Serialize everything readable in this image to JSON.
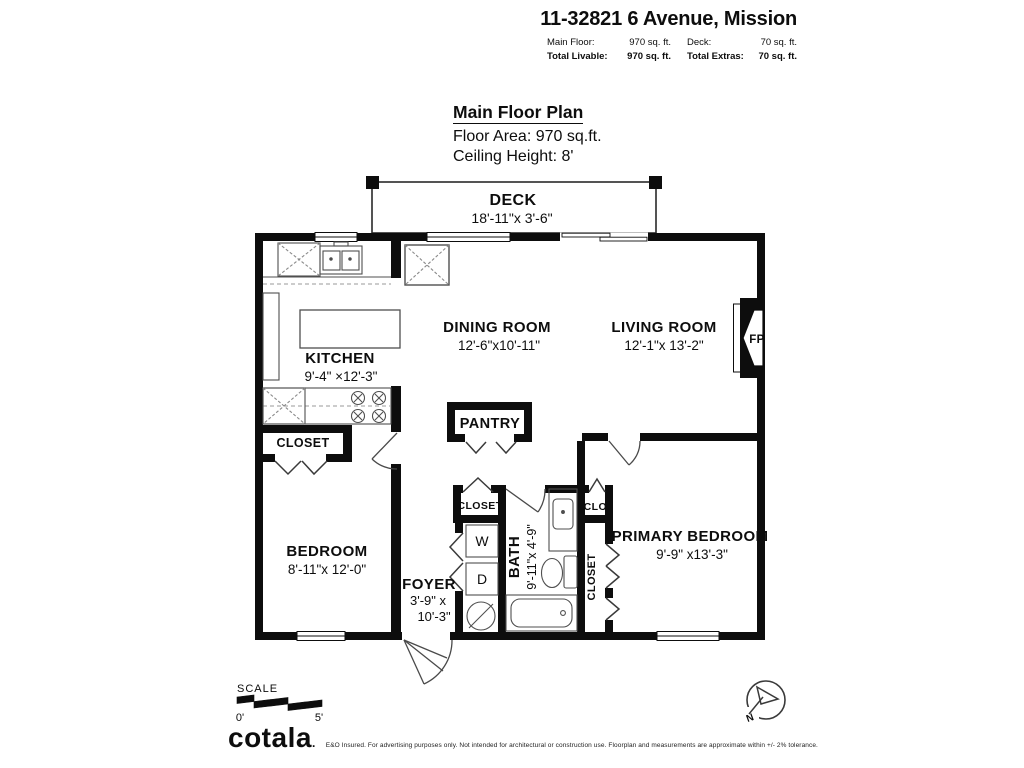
{
  "header": {
    "title": "11-32821 6 Avenue, Mission",
    "row1": {
      "label1": "Main Floor:",
      "value1": "970 sq. ft.",
      "label2": "Deck:",
      "value2": "70 sq. ft."
    },
    "row2": {
      "label1": "Total Livable:",
      "value1": "970 sq. ft.",
      "label2": "Total Extras:",
      "value2": "70 sq. ft."
    }
  },
  "plan_title": {
    "heading": "Main Floor Plan",
    "line1": "Floor Area: 970 sq.ft.",
    "line2": "Ceiling Height: 8'"
  },
  "rooms": {
    "deck": {
      "name": "DECK",
      "dims": "18'-11\"x 3'-6\""
    },
    "kitchen": {
      "name": "KITCHEN",
      "dims": "9'-4\" ×12'-3\""
    },
    "dining": {
      "name": "DINING ROOM",
      "dims": "12'-6\"x10'-11\""
    },
    "living": {
      "name": "LIVING ROOM",
      "dims": "12'-1\"x 13'-2\""
    },
    "pantry": {
      "name": "PANTRY"
    },
    "kitchen_closet": {
      "name": "CLOSET"
    },
    "bedroom": {
      "name": "BEDROOM",
      "dims": "8'-11\"x 12'-0\""
    },
    "foyer": {
      "name": "FOYER",
      "dims1": "3'-9\" x",
      "dims2": "10'-3\""
    },
    "foyer_closet": {
      "name": "CLOSET"
    },
    "laundry": {
      "washer": "W",
      "dryer": "D"
    },
    "bath": {
      "name": "BATH",
      "dims": "9'-11\"x 4'-9\""
    },
    "clo": {
      "name": "CLO."
    },
    "primary_closet": {
      "name": "CLOSET"
    },
    "primary": {
      "name": "PRIMARY BEDROOM",
      "dims": "9'-9\" x13'-3\""
    },
    "fireplace": {
      "label": "FP"
    }
  },
  "scale_bar": {
    "label": "SCALE",
    "tick_start": "0'",
    "tick_end": "5'"
  },
  "compass": {
    "north": "N"
  },
  "footer": {
    "logo": "cotala",
    "logo_mark": ".",
    "disclaimer": "E&O Insured. For advertising purposes only. Not intended for architectural or construction use. Floorplan and measurements are approximate within +/- 2% tolerance."
  }
}
